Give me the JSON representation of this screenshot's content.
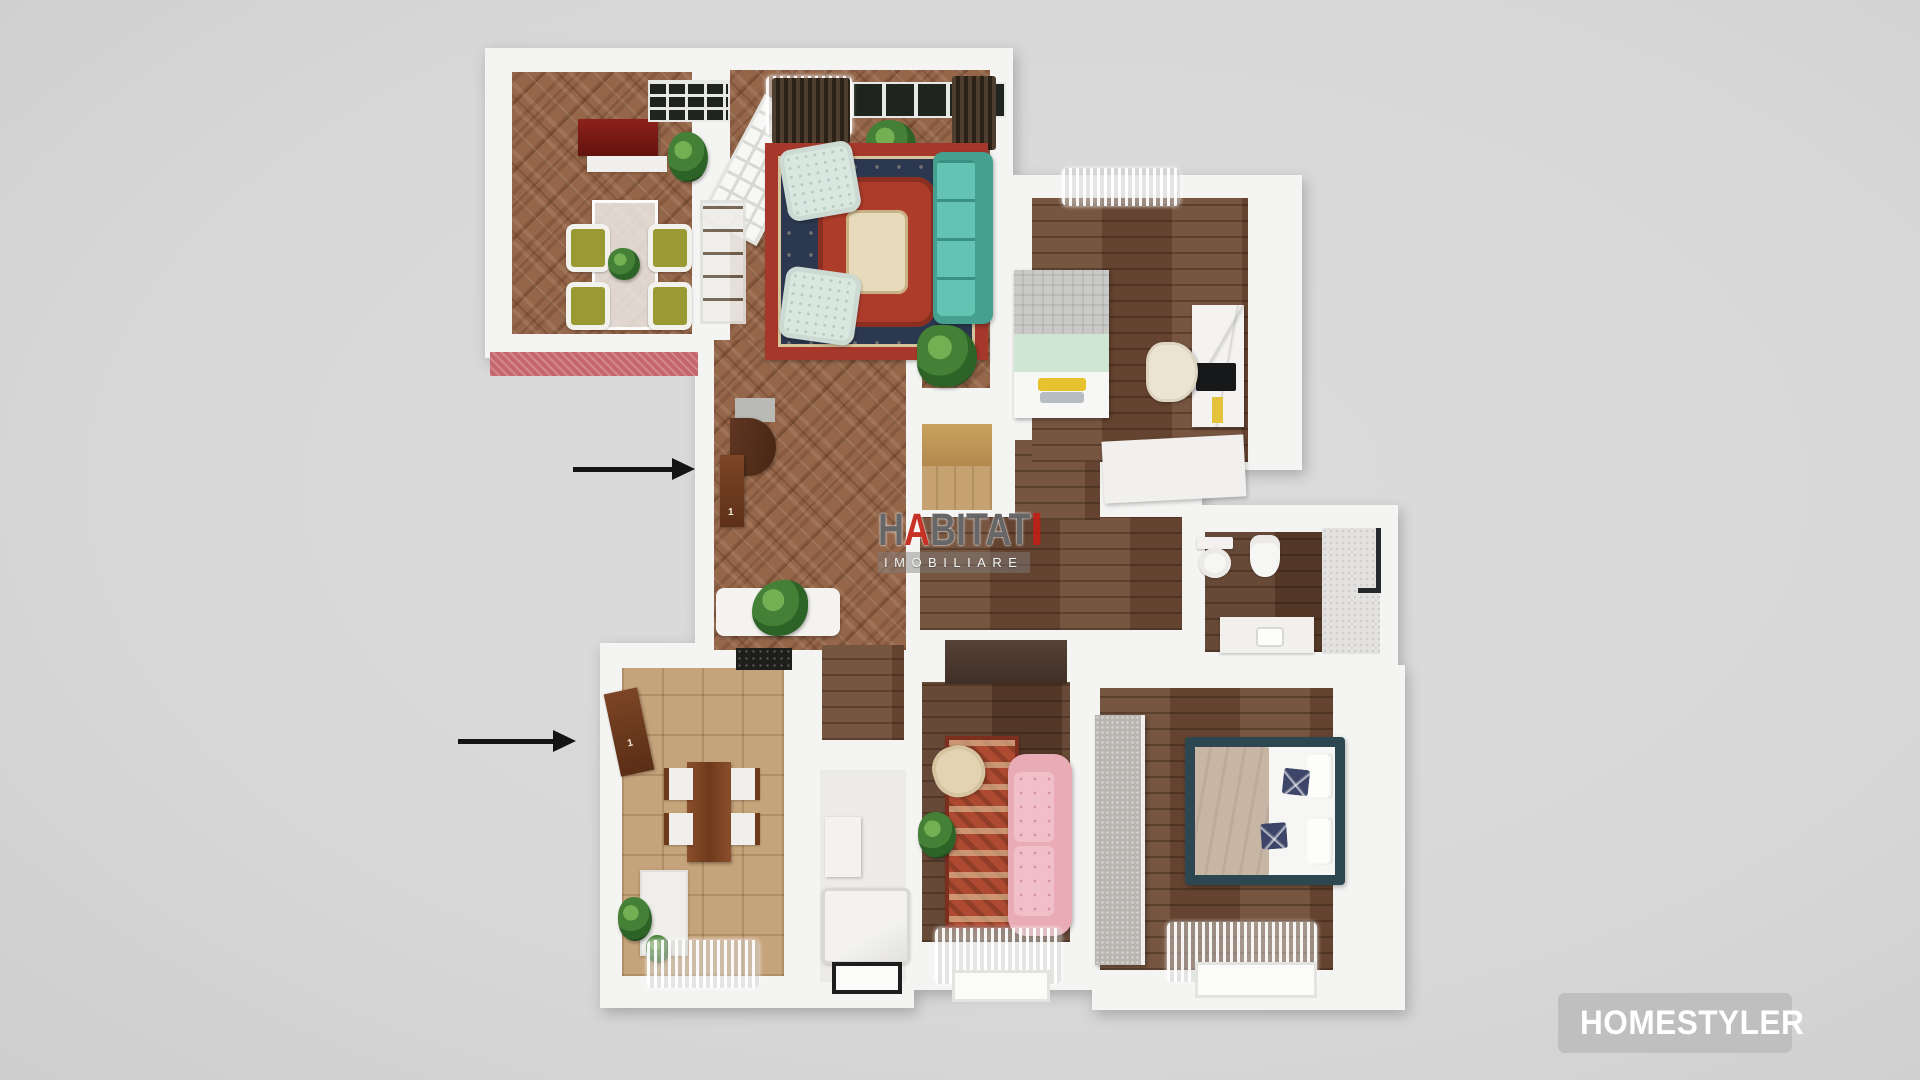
{
  "background_color": "#d9d9d9",
  "watermark": {
    "part1": "H",
    "accent": "A",
    "part2": "BITAT",
    "subtitle": "IMOBILIARE",
    "accent_color": "#c32014",
    "text_color": "#464646"
  },
  "logo_badge": {
    "label": "HOMESTYLER",
    "icon": "fan-swatch-icon",
    "background_color": "#bdbdbd",
    "text_color": "#ffffff"
  },
  "doors": {
    "main_entrance_label": "1",
    "kitchen_entrance_label": "1"
  },
  "annotations": {
    "arrows": [
      {
        "icon": "arrow-right-icon",
        "target": "main-entrance"
      },
      {
        "icon": "arrow-right-icon",
        "target": "kitchen-entrance"
      }
    ]
  },
  "palette": {
    "wall_white": "#f4f4f3",
    "herringbone_floor": "#95664a",
    "plank_floor": "#6f4b35",
    "kitchen_tile": "#c6a47b",
    "balcony_red": "#c4666b",
    "rug_red": "#a5372b",
    "rug_navy": "#2c3850",
    "sofa_teal": "#55b7a6",
    "sofa_pink": "#e9abb5",
    "bed_frame_teal": "#2d4750",
    "cabinet_red": "#7a1a14",
    "accent_plant_green": "#448035"
  }
}
